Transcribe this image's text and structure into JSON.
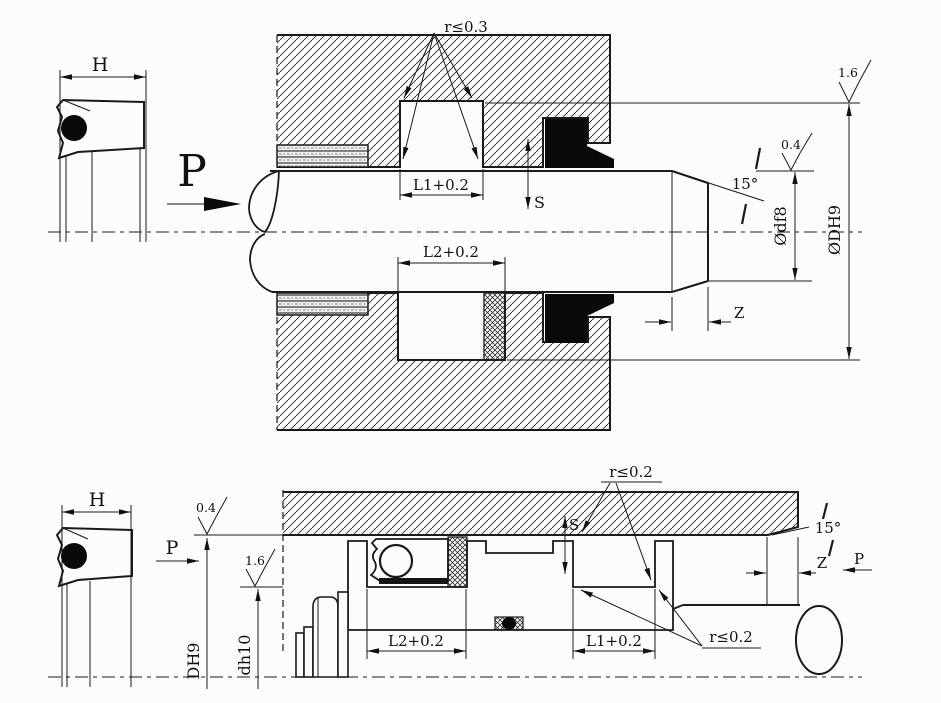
{
  "colors": {
    "background": "#fcfcfc",
    "line": "#1a1a1a",
    "seal_fill": "#0a0a0a"
  },
  "top_drawing": {
    "seal_section": {
      "width_dim": "H"
    },
    "pressure_label": "P",
    "corner_radius_note": "r≤0.3",
    "groove_dims": {
      "l1": "L1+0.2",
      "l2": "L2+0.2"
    },
    "clearance_dim": "S",
    "chamfer": {
      "angle": "15°",
      "length_dim": "Z"
    },
    "diameters": {
      "rod": "Ødf8",
      "groove_bore": "ØDH9"
    },
    "surface_roughness": {
      "groove": "1.6",
      "rod": "0.4"
    }
  },
  "bottom_drawing": {
    "seal_section": {
      "width_dim": "H"
    },
    "pressure_label_left": "P",
    "pressure_label_right": "P",
    "corner_radius_note_top": "r≤0.2",
    "corner_radius_note_bottom": "r≤0.2",
    "groove_dims": {
      "l1": "L1+0.2",
      "l2": "L2+0.2"
    },
    "clearance_dim": "S",
    "chamfer": {
      "angle": "15°",
      "length_dim": "Z"
    },
    "diameters": {
      "bore": "DH9",
      "groove_root": "dh10"
    },
    "surface_roughness": {
      "bore": "0.4",
      "groove": "1.6"
    }
  }
}
